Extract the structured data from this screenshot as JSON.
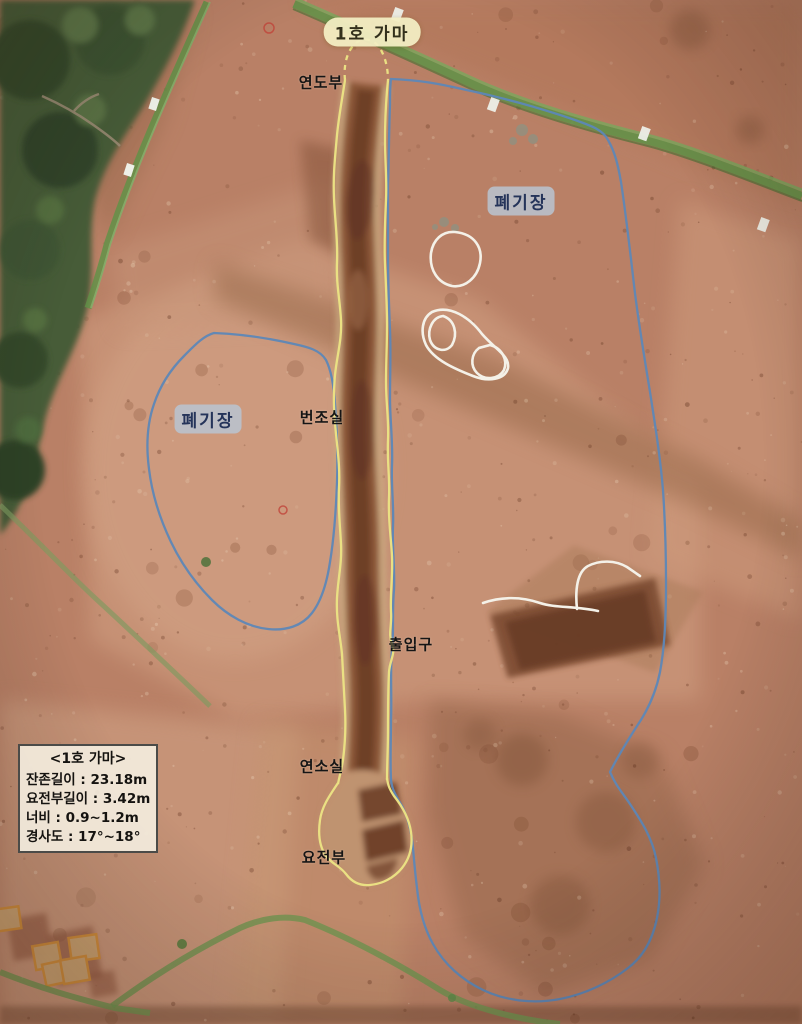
{
  "title": "1호 가마",
  "part_labels": {
    "flue": "연도부",
    "firing_chamber": "번조실",
    "entrance": "출입구",
    "combustion_chamber": "연소실",
    "kiln_front": "요전부"
  },
  "dump_labels": {
    "right": "폐기장",
    "left": "폐기장"
  },
  "info_box": {
    "title": "<1호 가마>",
    "line1": "잔존길이 : 23.18m",
    "line2": "요전부길이 : 3.42m",
    "line3": "너비 : 0.9~1.2m",
    "line4": "경사도 : 17°~18°"
  },
  "colors": {
    "kiln_outline": "#EAE083",
    "dump_outline": "#5D87B7",
    "feature_outline": "#F4F1E8",
    "title_pill_bg": "#F2EDC2F2",
    "title_text": "#33301C",
    "dump_pill_bg": "#B9C4D1D9",
    "dump_pill_text": "#25345A",
    "label_text": "#151515",
    "info_bg": "#F6F0E3E0",
    "info_border": "#4B4B48",
    "info_text": "#151310"
  }
}
